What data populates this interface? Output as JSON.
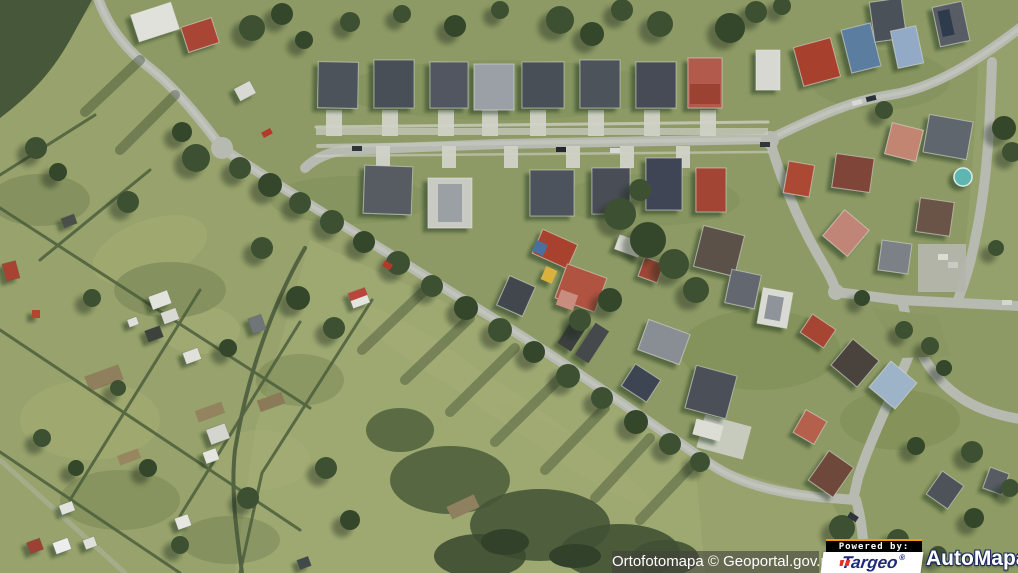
{
  "map": {
    "description": "aerial orthophoto of a suburban residential area with fields and allotment gardens",
    "attribution_text": "Ortofotomapa © Geoportal.gov.pl"
  },
  "branding": {
    "powered_by_label": "Powered by:",
    "targeo_name": "Targeo",
    "targeo_registered": "®",
    "automapa_name": "AutoMapa",
    "automapa_registered": "®",
    "colors": {
      "targeo_blue": "#1f2a78",
      "targeo_red": "#e03424",
      "powered_by_accent": "#f49b00",
      "powered_by_background": "#000000",
      "automapa_outline": "#1c2a5e",
      "attribution_background": "rgba(64,64,58,0.58)"
    }
  }
}
